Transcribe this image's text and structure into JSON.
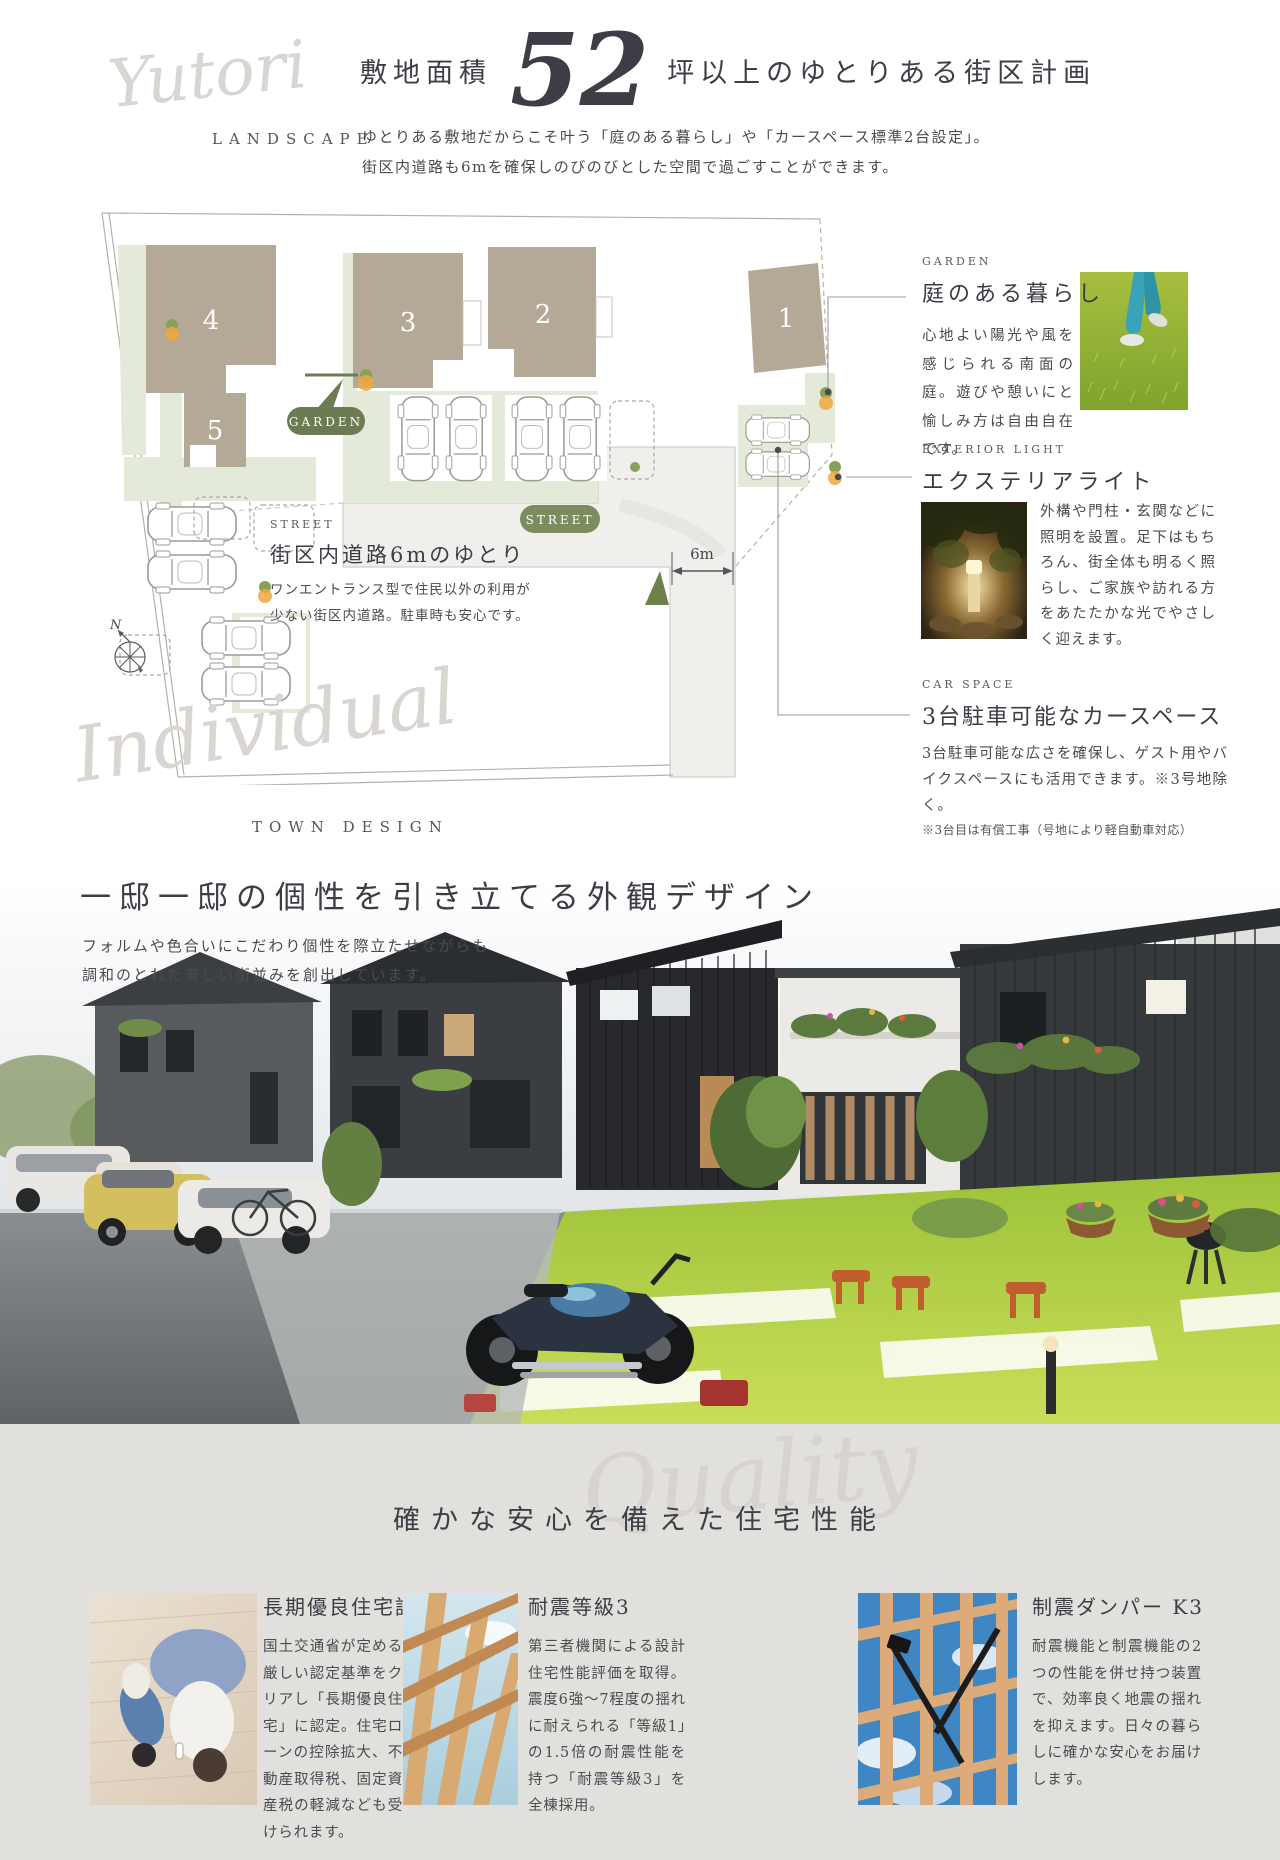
{
  "colors": {
    "accent_green_dark": "#6d7b52",
    "accent_green": "#7c8c5f",
    "sage": "#e3eada",
    "building_beige": "#b4a996",
    "section_bg": "#e2e0dd",
    "text_dark": "#3e3e46",
    "script_gray": "#d9d6d2"
  },
  "landscape_section": {
    "script_word": "Yutori",
    "script_label": "LANDSCAPE",
    "title_prefix": "敷地面積",
    "title_number": "52",
    "title_suffix": "坪以上のゆとりある街区計画",
    "desc_line1": "ゆとりある敷地だからこそ叶う「庭のある暮らし」や「カースペース標準2台設定」。",
    "desc_line2": "街区内道路も6mを確保しのびのびとした空間で過ごすことができます。"
  },
  "site_plan": {
    "lot_numbers": [
      "1",
      "2",
      "3",
      "4",
      "5"
    ],
    "garden_badge": "GARDEN",
    "street_badge": "STREET",
    "dimension_label": "6m",
    "compass_label": "N",
    "street_info": {
      "label": "STREET",
      "title": "街区内道路6mのゆとり",
      "desc_line1": "ワンエントランス型で住民以外の利用が",
      "desc_line2": "少ない街区内道路。駐車時も安心です。"
    }
  },
  "features": [
    {
      "label": "GARDEN",
      "title": "庭のある暮らし",
      "desc": "心地よい陽光や風を感じられる南面の庭。遊びや憩いにと愉しみ方は自由自在です。",
      "photo": "child-on-lawn"
    },
    {
      "label": "EXTERIOR LIGHT",
      "title": "エクステリアライト",
      "desc": "外構や門柱・玄関などに照明を設置。足下はもちろん、街全体も明るく照らし、ご家族や訪れる方をあたたかな光でやさしく迎えます。",
      "photo": "garden-light-at-night"
    },
    {
      "label": "CAR SPACE",
      "title": "3台駐車可能なカースペース",
      "desc": "3台駐車可能な広さを確保し、ゲスト用やバイクスペースにも活用できます。※3号地除く。",
      "note": "※3台目は有償工事（号地により軽自動車対応）",
      "photo": ""
    }
  ],
  "town_design_section": {
    "script_word": "Individual",
    "script_label": "TOWN DESIGN",
    "title": "一邸一邸の個性を引き立てる外観デザイン",
    "desc_line1": "フォルムや色合いにこだわり個性を際立たせながらも",
    "desc_line2": "調和のとれた美しい街並みを創出しています。",
    "photo": "streetscape-of-houses"
  },
  "quality_section": {
    "script_word": "Quality",
    "title": "確かな安心を備えた住宅性能",
    "items": [
      {
        "title": "長期優良住宅認定",
        "desc": "国土交通省が定める厳しい認定基準をクリアし「長期優良住宅」に認定。住宅ローンの控除拡大、不動産取得税、固定資産税の軽減なども受けられます。",
        "photo": "family-relaxing-on-floor"
      },
      {
        "title": "耐震等級3",
        "desc": "第三者機関による設計住宅性能評価を取得。震度6強〜7程度の揺れに耐えられる「等級1」の1.5倍の耐震性能を持つ「耐震等級3」を全棟採用。",
        "photo": "wooden-house-frame"
      },
      {
        "title": "制震ダンパー K3",
        "desc": "耐震機能と制震機能の2つの性能を併せ持つ装置で、効率良く地震の揺れを抑えます。日々の暮らしに確かな安心をお届けします。",
        "photo": "seismic-damper-frame"
      }
    ]
  }
}
